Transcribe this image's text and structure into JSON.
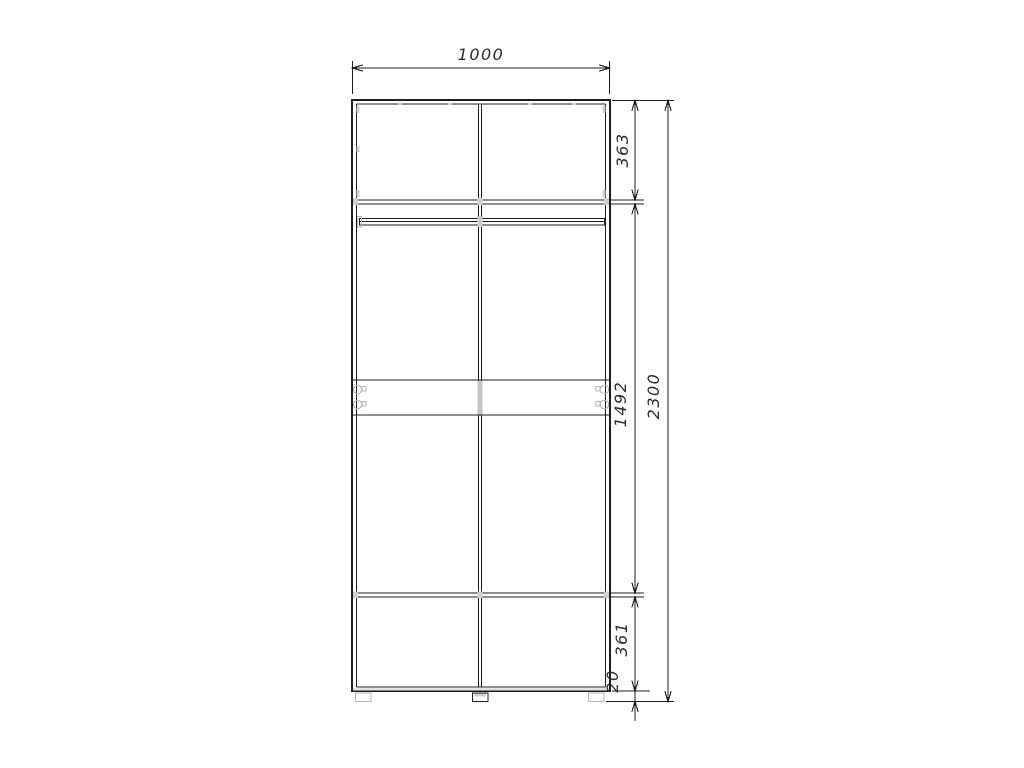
{
  "page": {
    "background": "#ffffff"
  },
  "drawing": {
    "type": "furniture-front-elevation",
    "subject": "two-door-wardrobe",
    "labels": {
      "width_total": "1000",
      "height_total": "2300",
      "section_top": "363",
      "section_middle": "1492",
      "section_bottom": "361",
      "plinth_height": "20"
    },
    "colors": {
      "line": "#1c1c1c",
      "hardware": "#b5b5b5",
      "panel_fill": "#e3e3e3",
      "text": "#2a2a2a",
      "background": "#ffffff"
    }
  }
}
